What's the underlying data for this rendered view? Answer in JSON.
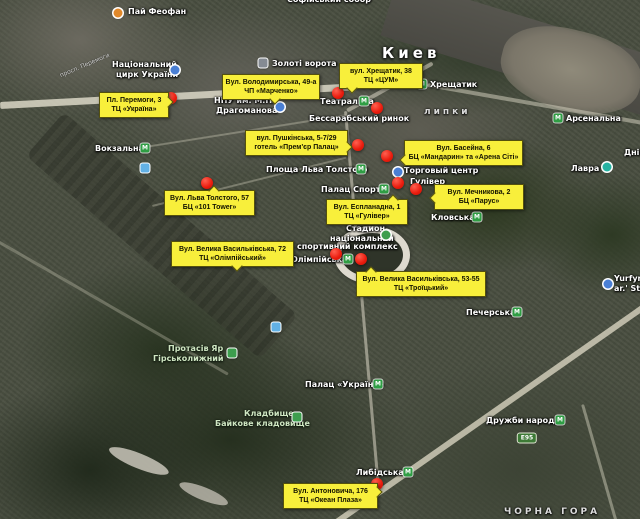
{
  "map": {
    "city_name": "Киев",
    "colors": {
      "callout_yellow": "#f8ef3b",
      "red_marker": "#ea1b0d",
      "metro_green": "#2f9e44",
      "poi_blue": "#4a7fd4",
      "nature_green": "#3d9e4e",
      "lavra_teal": "#26b3a2",
      "feofan_orange": "#e0882a",
      "train_blue": "#62b1e5",
      "route_badge_green": "#3d7a36"
    },
    "icon_glyphs": {
      "metro": "M"
    },
    "labels": [
      {
        "text": "Софійський собор",
        "x": 287,
        "y": -5,
        "cls": "poi",
        "name": "label-sofiysky-sobor"
      },
      {
        "text": "Пай Феофан",
        "x": 128,
        "y": 7,
        "cls": "poi",
        "name": "label-pai-feofan"
      },
      {
        "text": "Національний",
        "x": 112,
        "y": 60,
        "cls": "poi",
        "name": "label-circus-line1"
      },
      {
        "text": "цирк України",
        "x": 116,
        "y": 70,
        "cls": "poi",
        "name": "label-circus-line2"
      },
      {
        "text": "Золоті ворота",
        "x": 272,
        "y": 59,
        "cls": "poi",
        "name": "label-zoloti-vorota"
      },
      {
        "text": "Киев",
        "x": 382,
        "y": 44,
        "cls": "city",
        "name": "label-city-kyiv"
      },
      {
        "text": "Хрещатик",
        "x": 430,
        "y": 80,
        "cls": "poi",
        "name": "label-metro-khreshchatyk"
      },
      {
        "text": "Театральна",
        "x": 320,
        "y": 97,
        "cls": "poi",
        "name": "label-metro-teatralna"
      },
      {
        "text": "Бессарабський ринок",
        "x": 309,
        "y": 114,
        "cls": "poi",
        "name": "label-bessarabsky-rynok"
      },
      {
        "text": "липки",
        "x": 424,
        "y": 107,
        "cls": "area",
        "name": "label-lypky"
      },
      {
        "text": "Арсенальна",
        "x": 566,
        "y": 114,
        "cls": "poi",
        "name": "label-metro-arsenalna"
      },
      {
        "text": "НПУ им. М.П.",
        "x": 214,
        "y": 96,
        "cls": "poi",
        "name": "label-npu-line1"
      },
      {
        "text": "Драгоманова",
        "x": 216,
        "y": 106,
        "cls": "poi",
        "name": "label-npu-line2"
      },
      {
        "text": "Площа Льва Толстого",
        "x": 266,
        "y": 165,
        "cls": "poi",
        "name": "label-metro-ploshcha-lva-tolstoho"
      },
      {
        "text": "Палац Спорту",
        "x": 321,
        "y": 185,
        "cls": "poi",
        "name": "label-metro-palats-sportu"
      },
      {
        "text": "Торговый центр",
        "x": 404,
        "y": 166,
        "cls": "poi",
        "name": "label-torgovy-tsentr"
      },
      {
        "text": "Гулівер",
        "x": 410,
        "y": 177,
        "cls": "poi",
        "name": "label-gulliver"
      },
      {
        "text": "Кловська",
        "x": 431,
        "y": 213,
        "cls": "poi",
        "name": "label-metro-klovska"
      },
      {
        "text": "Стадион",
        "x": 346,
        "y": 224,
        "cls": "poi",
        "name": "label-stadium-line1"
      },
      {
        "text": "національний",
        "x": 330,
        "y": 234,
        "cls": "poi",
        "name": "label-stadium-line2"
      },
      {
        "text": "спортивний комплекс",
        "x": 297,
        "y": 242,
        "cls": "poi",
        "name": "label-stadium-line3"
      },
      {
        "text": "Олімпійська",
        "x": 291,
        "y": 255,
        "cls": "poi",
        "name": "label-metro-olimpiiska"
      },
      {
        "text": "Лавра",
        "x": 571,
        "y": 164,
        "cls": "poi",
        "name": "label-lavra"
      },
      {
        "text": "Дніпро",
        "x": 624,
        "y": 148,
        "cls": "poi",
        "name": "label-dnipro-partial"
      },
      {
        "text": "Yurfyrma",
        "x": 614,
        "y": 274,
        "cls": "poi",
        "name": "label-yurfyrma-line1"
      },
      {
        "text": "ar.' Str H",
        "x": 614,
        "y": 284,
        "cls": "poi",
        "name": "label-yurfyrma-line2"
      },
      {
        "text": "Печерська",
        "x": 466,
        "y": 308,
        "cls": "poi",
        "name": "label-metro-pecherska"
      },
      {
        "text": "Дружби народів",
        "x": 486,
        "y": 416,
        "cls": "poi",
        "name": "label-metro-druzhby-narodiv"
      },
      {
        "text": "Палац «Україна»",
        "x": 305,
        "y": 380,
        "cls": "poi",
        "name": "label-metro-palats-ukraina"
      },
      {
        "text": "Либідська",
        "x": 356,
        "y": 468,
        "cls": "poi",
        "name": "label-metro-lybidska"
      },
      {
        "text": "Вокзальна",
        "x": 95,
        "y": 144,
        "cls": "poi",
        "name": "label-metro-vokzalna"
      },
      {
        "text": "Протасів Яр",
        "x": 168,
        "y": 344,
        "cls": "nature",
        "name": "label-protasiv-yar-line1"
      },
      {
        "text": "Гірськолижний",
        "x": 153,
        "y": 354,
        "cls": "nature",
        "name": "label-protasiv-yar-line2"
      },
      {
        "text": "Кладбище",
        "x": 244,
        "y": 409,
        "cls": "nature",
        "name": "label-cemetery-line1"
      },
      {
        "text": "Байкове кладовище",
        "x": 215,
        "y": 419,
        "cls": "nature",
        "name": "label-cemetery-line2"
      },
      {
        "text": "ЧОРНА ГОРА",
        "x": 504,
        "y": 507,
        "cls": "area",
        "name": "label-chorna-hora"
      },
      {
        "text": "просп. Перемоги",
        "x": 58,
        "y": 62,
        "cls": "road",
        "rot": -23,
        "name": "label-peremohy-avenue"
      }
    ],
    "icons": [
      {
        "type": "dot",
        "x": 118,
        "y": 13,
        "color": "#e0882a",
        "name": "feofan-poi-icon"
      },
      {
        "type": "dot",
        "x": 175,
        "y": 70,
        "color": "#4a7fd4",
        "name": "circus-icon"
      },
      {
        "type": "sq",
        "x": 263,
        "y": 63,
        "color": "#858b93",
        "name": "golden-gate-landmark-icon"
      },
      {
        "type": "dot",
        "x": 280,
        "y": 107,
        "color": "#4a7fd4",
        "name": "university-icon"
      },
      {
        "type": "metro",
        "x": 422,
        "y": 84,
        "name": "metro-khreshchatyk-icon"
      },
      {
        "type": "metro",
        "x": 364,
        "y": 101,
        "name": "metro-teatralna-icon"
      },
      {
        "type": "metro",
        "x": 558,
        "y": 118,
        "name": "metro-arsenalna-icon"
      },
      {
        "type": "metro",
        "x": 361,
        "y": 169,
        "name": "metro-ploshcha-lva-tolstoho-icon"
      },
      {
        "type": "metro",
        "x": 384,
        "y": 189,
        "name": "metro-palats-sportu-icon"
      },
      {
        "type": "metro",
        "x": 477,
        "y": 217,
        "name": "metro-klovska-icon"
      },
      {
        "type": "metro",
        "x": 348,
        "y": 259,
        "name": "metro-olimpiiska-icon"
      },
      {
        "type": "metro",
        "x": 517,
        "y": 312,
        "name": "metro-pecherska-icon"
      },
      {
        "type": "metro",
        "x": 560,
        "y": 420,
        "name": "metro-druzhby-narodiv-icon"
      },
      {
        "type": "metro",
        "x": 378,
        "y": 384,
        "name": "metro-palats-ukraina-icon"
      },
      {
        "type": "metro",
        "x": 408,
        "y": 472,
        "name": "metro-lybidska-icon"
      },
      {
        "type": "metro",
        "x": 145,
        "y": 148,
        "name": "metro-vokzalna-icon"
      },
      {
        "type": "dot",
        "x": 398,
        "y": 172,
        "color": "#4a7fd4",
        "name": "shopping-mall-icon"
      },
      {
        "type": "dot",
        "x": 607,
        "y": 167,
        "color": "#26b3a2",
        "name": "lavra-icon"
      },
      {
        "type": "dot",
        "x": 608,
        "y": 284,
        "color": "#4a7fd4",
        "name": "yurfyrma-icon"
      },
      {
        "type": "sq",
        "x": 232,
        "y": 353,
        "color": "#3d9e4e",
        "name": "ski-area-icon"
      },
      {
        "type": "sq",
        "x": 297,
        "y": 417,
        "color": "#3d9e4e",
        "name": "cemetery-icon"
      },
      {
        "type": "dot",
        "x": 386,
        "y": 235,
        "color": "#3d9e4e",
        "name": "stadium-icon"
      },
      {
        "type": "sq",
        "x": 145,
        "y": 168,
        "color": "#62b1e5",
        "name": "train-station-icon"
      },
      {
        "type": "sq",
        "x": 276,
        "y": 327,
        "color": "#62b1e5",
        "name": "transit-stop-icon"
      },
      {
        "type": "badge",
        "x": 527,
        "y": 438,
        "text": "E95",
        "name": "route-badge-e95"
      }
    ],
    "red_markers": [
      {
        "x": 171,
        "y": 98
      },
      {
        "x": 338,
        "y": 93
      },
      {
        "x": 377,
        "y": 108
      },
      {
        "x": 358,
        "y": 145
      },
      {
        "x": 387,
        "y": 156
      },
      {
        "x": 398,
        "y": 183
      },
      {
        "x": 416,
        "y": 189
      },
      {
        "x": 207,
        "y": 183
      },
      {
        "x": 336,
        "y": 254
      },
      {
        "x": 361,
        "y": 259
      },
      {
        "x": 377,
        "y": 484
      }
    ],
    "callouts": [
      {
        "name": "callout-tc-ukraina",
        "lines": [
          "Пл. Перемоги, 3",
          "ТЦ «Україна»"
        ],
        "x": 99,
        "y": 92,
        "w": 64,
        "tail": "right",
        "tp": 22
      },
      {
        "name": "callout-chp-marchenko",
        "lines": [
          "Вул. Володимирська, 49-а",
          "ЧП «Марченко»"
        ],
        "x": 222,
        "y": 74,
        "w": 92,
        "tail": "bottom",
        "tp": 50
      },
      {
        "name": "callout-tc-tsum",
        "lines": [
          "вул. Хрещатик, 38",
          "ТЦ «ЦУМ»"
        ],
        "x": 339,
        "y": 63,
        "w": 78,
        "tail": "bottom",
        "tp": 10
      },
      {
        "name": "callout-premier-palace",
        "lines": [
          "вул. Пушкінська, 5-7/29",
          "готель «Прем'єр Палац»"
        ],
        "x": 245,
        "y": 130,
        "w": 97,
        "tail": "right",
        "tp": 50
      },
      {
        "name": "callout-mandarin-arena-city",
        "lines": [
          "Вул. Басейна, 6",
          "БЦ «Мандарин» та «Арена Сіті»"
        ],
        "x": 404,
        "y": 140,
        "w": 113,
        "tail": "left",
        "tp": 62
      },
      {
        "name": "callout-parus",
        "lines": [
          "Вул. Мечникова, 2",
          "БЦ «Парус»"
        ],
        "x": 434,
        "y": 184,
        "w": 84,
        "tail": "left",
        "tp": 38
      },
      {
        "name": "callout-101-tower",
        "lines": [
          "Вул. Льва Толстого, 57",
          "БЦ «101 Tower»"
        ],
        "x": 164,
        "y": 190,
        "w": 85,
        "tail": "top",
        "tp": 50
      },
      {
        "name": "callout-gulliver",
        "lines": [
          "Вул. Еспланадна, 1",
          "ТЦ «Гулівер»"
        ],
        "x": 326,
        "y": 199,
        "w": 76,
        "tail": "top",
        "tp": 78
      },
      {
        "name": "callout-olimpiyskiy",
        "lines": [
          "Вул. Велика Васильківська, 72",
          "ТЦ «Олімпійський»"
        ],
        "x": 171,
        "y": 241,
        "w": 117,
        "tail": "bottom",
        "tp": 50
      },
      {
        "name": "callout-troitskiy",
        "lines": [
          "Вул. Велика Васильківська, 53-55",
          "ТЦ «Троїцький»"
        ],
        "x": 356,
        "y": 271,
        "w": 124,
        "tail": "top",
        "tp": 8
      },
      {
        "name": "callout-ocean-plaza",
        "lines": [
          "Вул. Антоновича, 176",
          "ТЦ «Океан Плаза»"
        ],
        "x": 283,
        "y": 483,
        "w": 89,
        "tail": "right",
        "tp": 15
      }
    ]
  }
}
